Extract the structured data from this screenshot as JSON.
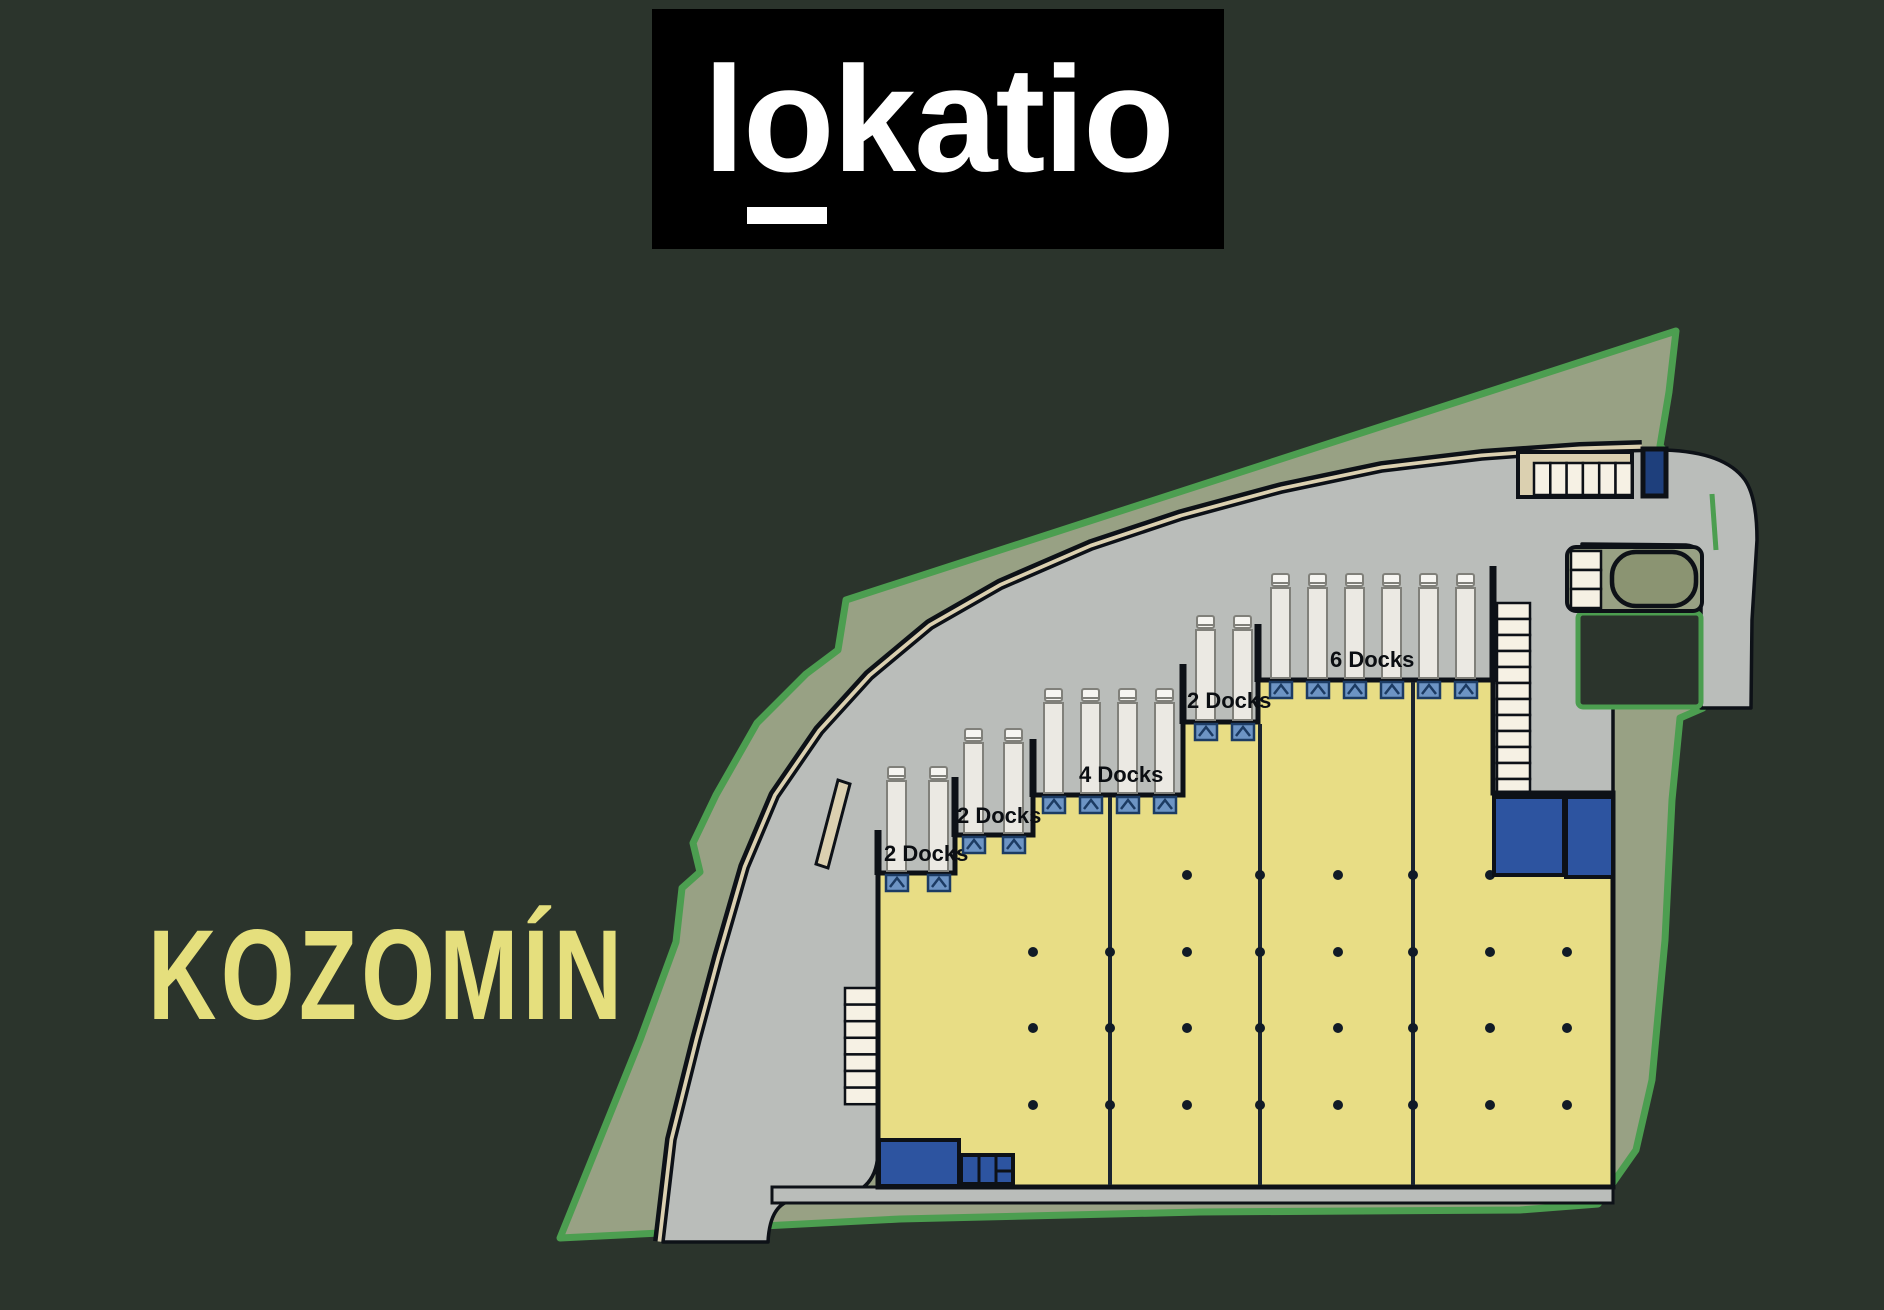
{
  "background_color": "#2b342c",
  "logo": {
    "text_full": "lokatio",
    "part_before": "l",
    "part_underlined": "o",
    "part_after": "katio",
    "bg_color": "#000000",
    "text_color": "#ffffff"
  },
  "location_label": {
    "text": "KOZOMÍN",
    "color": "#e5df7d"
  },
  "site_plan": {
    "dock_sections": [
      {
        "label": "2 Docks",
        "docks": 2
      },
      {
        "label": "2 Docks",
        "docks": 2
      },
      {
        "label": "4 Docks",
        "docks": 4
      },
      {
        "label": "2 Docks",
        "docks": 2
      },
      {
        "label": "6 Docks",
        "docks": 6
      }
    ],
    "parking": {
      "upper_row_stalls": 6,
      "left_column_stalls": 7,
      "right_column_stalls": 12,
      "island_stalls": 3
    },
    "colors": {
      "boundary_green": "#4c9e50",
      "buffer_sage": "#98a184",
      "road_gray": "#babdba",
      "path_tan": "#dbd0b0",
      "building_yellow": "#e8dd85",
      "outline_black": "#0d1117",
      "dock_door_blue": "#6d94c4",
      "dock_door_dark": "#1c3b63",
      "office_blue": "#2d54a0",
      "stall_beige": "#f6f1e4",
      "truck_body": "#ebe9e3",
      "column_dot": "#111b26"
    }
  }
}
